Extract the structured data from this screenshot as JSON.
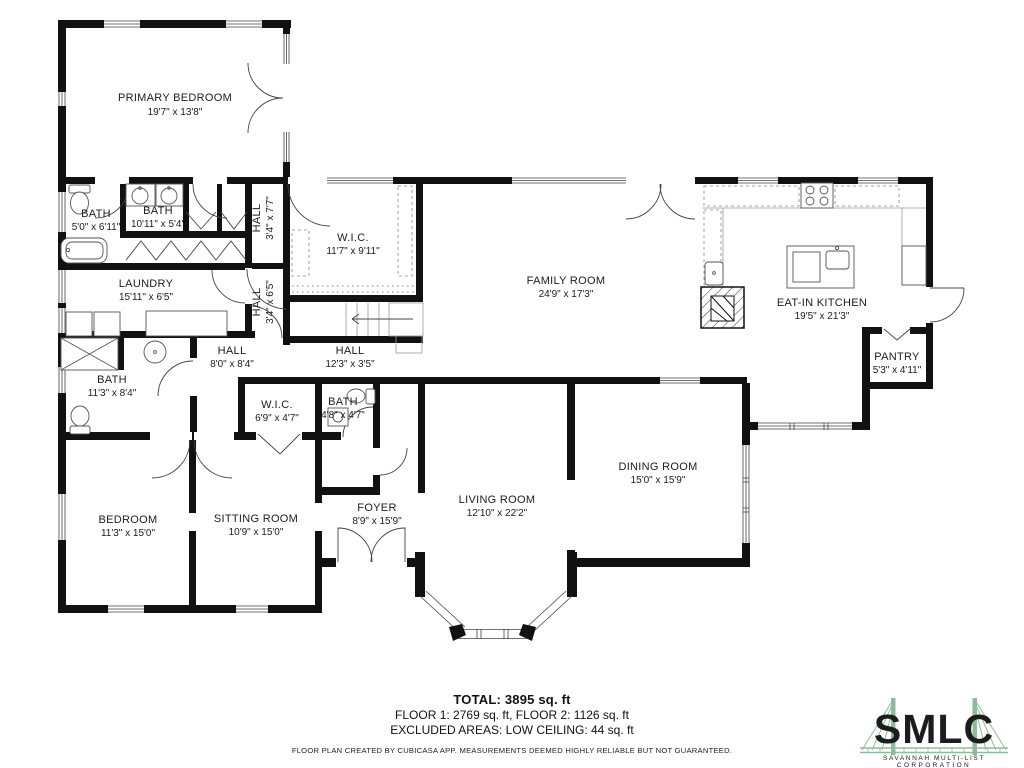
{
  "rooms": [
    {
      "name": "PRIMARY BEDROOM",
      "dims": "19'7\" x 13'8\""
    },
    {
      "name": "BATH",
      "dims": "5'0\" x 6'11\""
    },
    {
      "name": "BATH",
      "dims": "10'11\" x 5'4\""
    },
    {
      "name": "HALL",
      "dims": "3'4\" x 7'7\""
    },
    {
      "name": "LAUNDRY",
      "dims": "15'11\" x 6'5\""
    },
    {
      "name": "HALL",
      "dims": "3'4\" x 6'5\""
    },
    {
      "name": "W.I.C.",
      "dims": "11'7\" x 9'11\""
    },
    {
      "name": "FAMILY ROOM",
      "dims": "24'9\" x 17'3\""
    },
    {
      "name": "HALL",
      "dims": "12'3\" x 3'5\""
    },
    {
      "name": "HALL",
      "dims": "8'0\" x 8'4\""
    },
    {
      "name": "BATH",
      "dims": "11'3\" x 8'4\""
    },
    {
      "name": "W.I.C.",
      "dims": "6'9\" x 4'7\""
    },
    {
      "name": "BATH",
      "dims": "4'8\" x 4'7\""
    },
    {
      "name": "EAT-IN KITCHEN",
      "dims": "19'5\" x 21'3\""
    },
    {
      "name": "PANTRY",
      "dims": "5'3\" x 4'11\""
    },
    {
      "name": "DINING ROOM",
      "dims": "15'0\" x 15'9\""
    },
    {
      "name": "LIVING ROOM",
      "dims": "12'10\" x 22'2\""
    },
    {
      "name": "FOYER",
      "dims": "8'9\" x 15'9\""
    },
    {
      "name": "BEDROOM",
      "dims": "11'3\" x 15'0\""
    },
    {
      "name": "SITTING ROOM",
      "dims": "10'9\" x 15'0\""
    }
  ],
  "footer": {
    "total": "TOTAL: 3895 sq. ft",
    "floors": "FLOOR 1: 2769 sq. ft, FLOOR 2: 1126 sq. ft",
    "excluded": "EXCLUDED AREAS: LOW CEILING: 44 sq. ft",
    "disclaimer": "FLOOR PLAN CREATED BY CUBICASA APP. MEASUREMENTS DEEMED HIGHLY RELIABLE BUT NOT GUARANTEED."
  },
  "logo": {
    "name": "SMLC",
    "line1": "SAVANNAH MULTI-LIST",
    "line2": "CORPORATION",
    "color": "#8dbc9c"
  },
  "colors": {
    "walls": "#111111",
    "text": "#1c1c1c"
  }
}
